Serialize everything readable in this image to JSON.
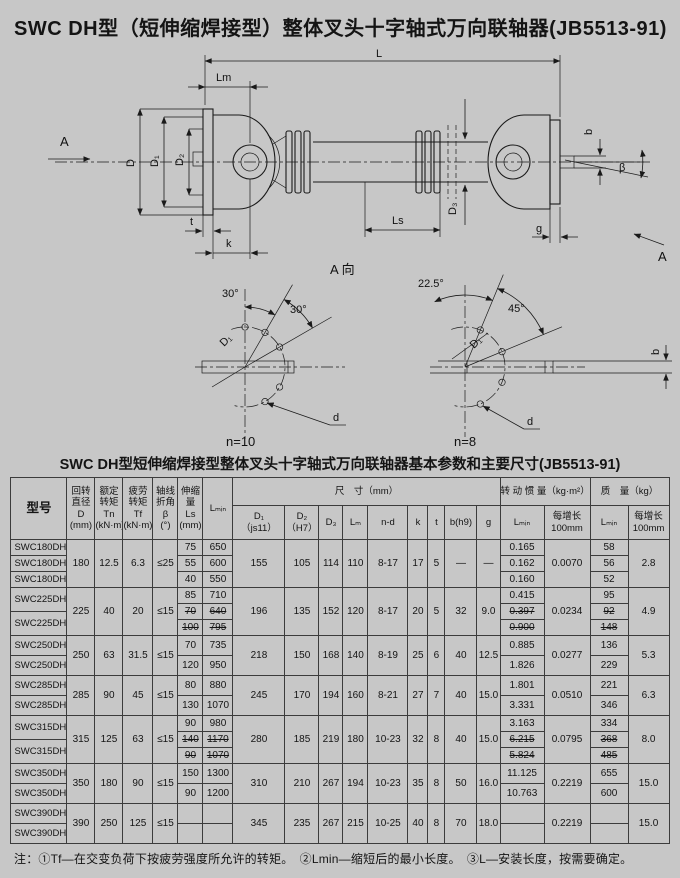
{
  "page": {
    "title": "SWC DH型（短伸缩焊接型）整体叉头十字轴式万向联轴器(JB5513-91)"
  },
  "drawing": {
    "labels": {
      "A": "A",
      "L": "L",
      "Lm": "Lm",
      "D": "D",
      "D1": "D₁",
      "D2": "D₂",
      "D3": "D₃",
      "t": "t",
      "k": "k",
      "Ls": "Ls",
      "b": "b",
      "beta": "β",
      "g": "g",
      "view": "A 向"
    },
    "left_detail": {
      "angle1": "30°",
      "angle2": "30°",
      "dia": "D₁",
      "hole": "d",
      "count": "n=10"
    },
    "right_detail": {
      "angle1": "22.5°",
      "angle2": "45°",
      "dia": "D₁",
      "hole": "d",
      "count": "n=8"
    }
  },
  "table": {
    "title": "SWC DH型短伸缩焊接型整体叉头十字轴式万向联轴器基本参数和主要尺寸(JB5513-91)",
    "headers": {
      "model": "型号",
      "D": "回转\n直径\nD\n(mm)",
      "Tn": "额定\n转矩\nTn\n(kN·m)",
      "Tf": "疲劳\n转矩\nTf\n(kN·m)",
      "beta": "轴线\n折角\nβ\n(°)",
      "Ls": "伸缩\n量\nLs\n(mm)",
      "Lmin": "Lₘᵢₙ",
      "size": "尺　寸（mm）",
      "D1": "D₁\n（js11）",
      "D2": "D₂\n（H7）",
      "D3": "D₃",
      "Lm": "Lₘ",
      "nd": "n-d",
      "k": "k",
      "t": "t",
      "b": "b(h9)",
      "g": "g",
      "inertia": "转 动 惯 量（kg·m²）",
      "mass": "质　量（kg）",
      "per100": "每增长\n100mm"
    },
    "groups": [
      {
        "models": [
          "SWC180DH1",
          "SWC180DH2",
          "SWC180DH3"
        ],
        "D": "180",
        "Tn": "12.5",
        "Tf": "6.3",
        "beta": "≤25",
        "rows": [
          {
            "ls": "75",
            "lmin": "650",
            "j": "0.165",
            "m": "58"
          },
          {
            "ls": "55",
            "lmin": "600",
            "j": "0.162",
            "m": "56"
          },
          {
            "ls": "40",
            "lmin": "550",
            "j": "0.160",
            "m": "52"
          }
        ],
        "D1": "155",
        "D2": "105",
        "D3": "114",
        "Lm": "110",
        "nd": "8-17",
        "k": "17",
        "t": "5",
        "b": "—",
        "g": "—",
        "j100": "0.0070",
        "m100": "2.8"
      },
      {
        "models": [
          "SWC225DH1",
          "SWC225DH2"
        ],
        "D": "225",
        "Tn": "40",
        "Tf": "20",
        "beta": "≤15",
        "rows": [
          {
            "ls": "85",
            "lmin": "710",
            "j": "0.415",
            "m": "95"
          },
          {
            "ls": "70",
            "lmin": "640",
            "j": "0.397",
            "m": "92",
            "s": true
          },
          {
            "ls": "100",
            "lmin": "795",
            "j": "0.900",
            "m": "148",
            "s": true
          }
        ],
        "D1": "196",
        "D2": "135",
        "D3": "152",
        "Lm": "120",
        "nd": "8-17",
        "k": "20",
        "t": "5",
        "b": "32",
        "g": "9.0",
        "j100": "0.0234",
        "m100": "4.9"
      },
      {
        "models": [
          "SWC250DH1",
          "SWC250DH2"
        ],
        "D": "250",
        "Tn": "63",
        "Tf": "31.5",
        "beta": "≤15",
        "rows": [
          {
            "ls": "70",
            "lmin": "735",
            "j": "0.885",
            "m": "136"
          },
          {
            "ls": "120",
            "lmin": "950",
            "j": "1.826",
            "m": "229"
          }
        ],
        "D1": "218",
        "D2": "150",
        "D3": "168",
        "Lm": "140",
        "nd": "8-19",
        "k": "25",
        "t": "6",
        "b": "40",
        "g": "12.5",
        "j100": "0.0277",
        "m100": "5.3"
      },
      {
        "models": [
          "SWC285DH1",
          "SWC285DH2"
        ],
        "D": "285",
        "Tn": "90",
        "Tf": "45",
        "beta": "≤15",
        "rows": [
          {
            "ls": "80",
            "lmin": "880",
            "j": "1.801",
            "m": "221"
          },
          {
            "ls": "130",
            "lmin": "1070",
            "j": "3.331",
            "m": "346"
          }
        ],
        "D1": "245",
        "D2": "170",
        "D3": "194",
        "Lm": "160",
        "nd": "8-21",
        "k": "27",
        "t": "7",
        "b": "40",
        "g": "15.0",
        "j100": "0.0510",
        "m100": "6.3"
      },
      {
        "models": [
          "SWC315DH1",
          "SWC315DH2"
        ],
        "D": "315",
        "Tn": "125",
        "Tf": "63",
        "beta": "≤15",
        "rows": [
          {
            "ls": "90",
            "lmin": "980",
            "j": "3.163",
            "m": "334"
          },
          {
            "ls": "140",
            "lmin": "1170",
            "j": "6.215",
            "m": "368",
            "s": true
          },
          {
            "ls": "90",
            "lmin": "1070",
            "j": "5.824",
            "m": "485",
            "s": true
          }
        ],
        "D1": "280",
        "D2": "185",
        "D3": "219",
        "Lm": "180",
        "nd": "10-23",
        "k": "32",
        "t": "8",
        "b": "40",
        "g": "15.0",
        "j100": "0.0795",
        "m100": "8.0"
      },
      {
        "models": [
          "SWC350DH1",
          "SWC350DH2"
        ],
        "D": "350",
        "Tn": "180",
        "Tf": "90",
        "beta": "≤15",
        "rows": [
          {
            "ls": "150",
            "lmin": "1300",
            "j": "11.125",
            "m": "655"
          },
          {
            "ls": "90",
            "lmin": "1200",
            "j": "10.763",
            "m": "600"
          }
        ],
        "D1": "310",
        "D2": "210",
        "D3": "267",
        "Lm": "194",
        "nd": "10-23",
        "k": "35",
        "t": "8",
        "b": "50",
        "g": "16.0",
        "j100": "0.2219",
        "m100": "15.0"
      },
      {
        "models": [
          "SWC390DH1",
          "SWC390DH2"
        ],
        "D": "390",
        "Tn": "250",
        "Tf": "125",
        "beta": "≤15",
        "rows": [
          {
            "ls": "",
            "lmin": "",
            "j": "",
            "m": ""
          },
          {
            "ls": "",
            "lmin": "",
            "j": "",
            "m": ""
          }
        ],
        "D1": "345",
        "D2": "235",
        "D3": "267",
        "Lm": "215",
        "nd": "10-25",
        "k": "40",
        "t": "8",
        "b": "70",
        "g": "18.0",
        "j100": "0.2219",
        "m100": "15.0"
      }
    ]
  },
  "note": "注：①Tf—在交变负荷下按疲劳强度所允许的转矩。　②Lmin—缩短后的最小长度。　③L—安装长度，按需要确定。"
}
